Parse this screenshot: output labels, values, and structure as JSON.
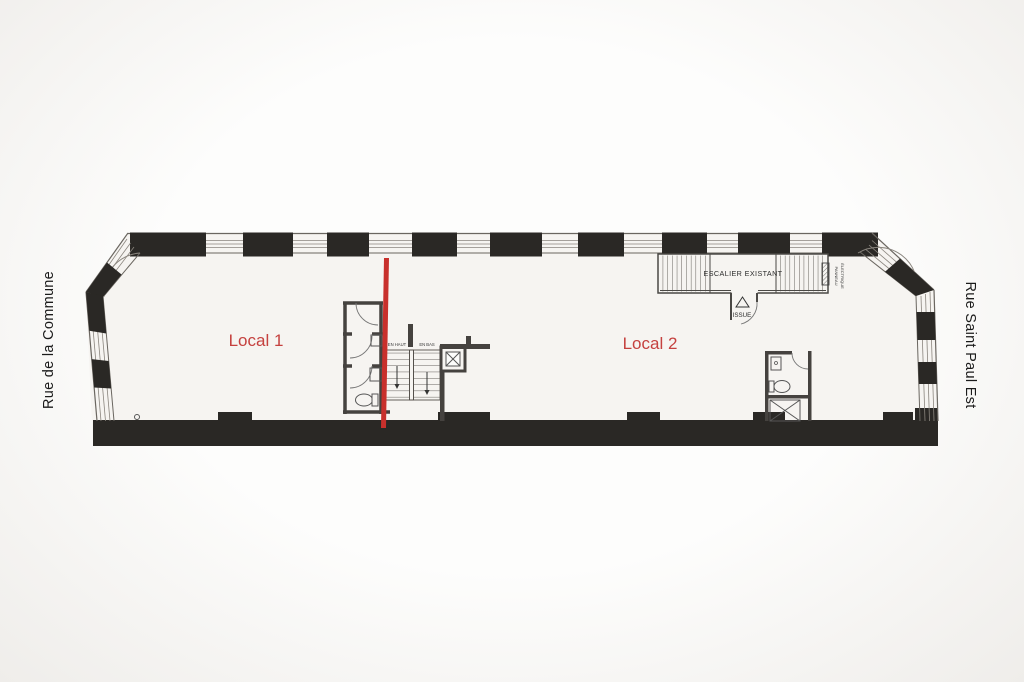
{
  "plan": {
    "streets": {
      "left": "Rue de la Commune",
      "right": "Rue Saint Paul Est"
    },
    "units": {
      "local1": "Local 1",
      "local2": "Local 2"
    },
    "stairs": {
      "existing": "ESCALIER EXISTANT",
      "up": "EN HAUT",
      "down": "EN BAS"
    },
    "exit_label": "ISSUE",
    "electrical_panel": {
      "line1": "PANNEAU",
      "line2": "ÉLECTRIQUE"
    },
    "colors": {
      "divider_red": "#c8302c",
      "unit_label_red": "#c5413f",
      "wall_dark": "#2a2825",
      "partition_gray": "#45423f"
    }
  }
}
